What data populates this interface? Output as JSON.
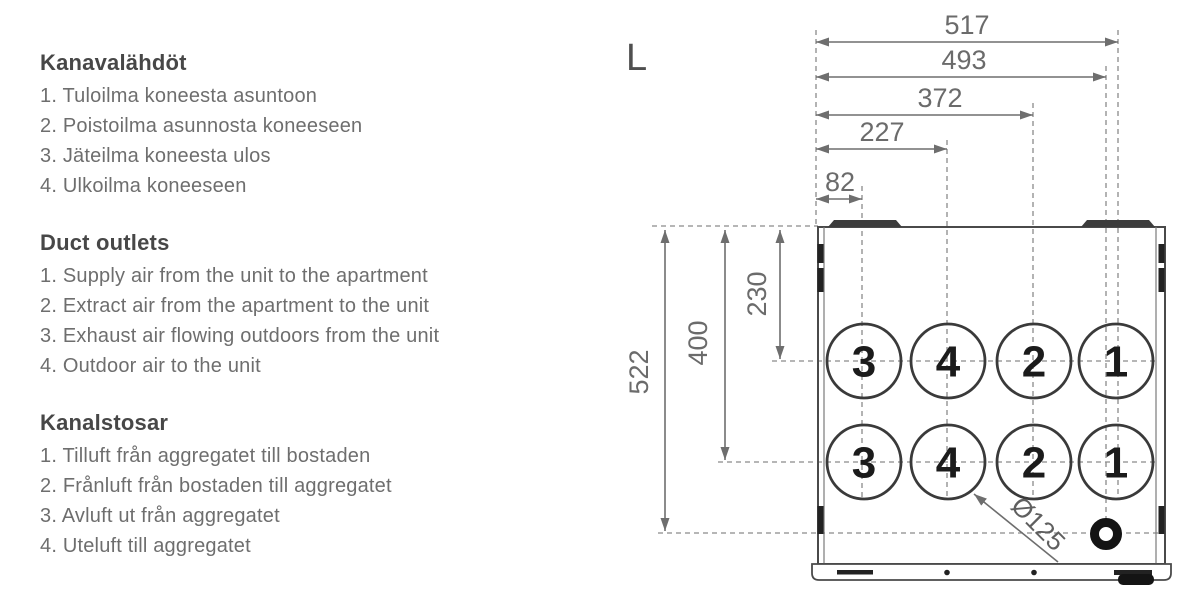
{
  "sections": [
    {
      "heading": "Kanavalähdöt",
      "items": [
        "1. Tuloilma koneesta asuntoon",
        "2. Poistoilma asunnosta koneeseen",
        "3. Jäteilma koneesta ulos",
        "4. Ulkoilma koneeseen"
      ]
    },
    {
      "heading": "Duct outlets",
      "items": [
        "1. Supply air from the unit to the apartment",
        "2. Extract air from the apartment to the unit",
        "3. Exhaust air flowing outdoors from the unit",
        "4. Outdoor air to the unit"
      ]
    },
    {
      "heading": "Kanalstosar",
      "items": [
        "1. Tilluft från aggregatet till bostaden",
        "2. Frånluft från bostaden till aggregatet",
        "3. Avluft ut från aggregatet",
        "4. Uteluft till aggregatet"
      ]
    }
  ],
  "diagram": {
    "view_label": "L",
    "horizontal_dims": [
      {
        "label": "517"
      },
      {
        "label": "493"
      },
      {
        "label": "372"
      },
      {
        "label": "227"
      },
      {
        "label": "82"
      }
    ],
    "vertical_dims": [
      {
        "label": "522"
      },
      {
        "label": "400"
      },
      {
        "label": "230"
      }
    ],
    "diameter_label": "Ø125",
    "outlet_rows": [
      [
        "3",
        "4",
        "2",
        "1"
      ],
      [
        "3",
        "4",
        "2",
        "1"
      ]
    ],
    "colors": {
      "dim_line": "#6e6e6e",
      "dashed_line": "#8a8a8a",
      "body_line": "#4a4a4a",
      "dark_detail": "#1f1f1f",
      "item_text": "#6e6e6e",
      "heading_text": "#474747"
    }
  }
}
